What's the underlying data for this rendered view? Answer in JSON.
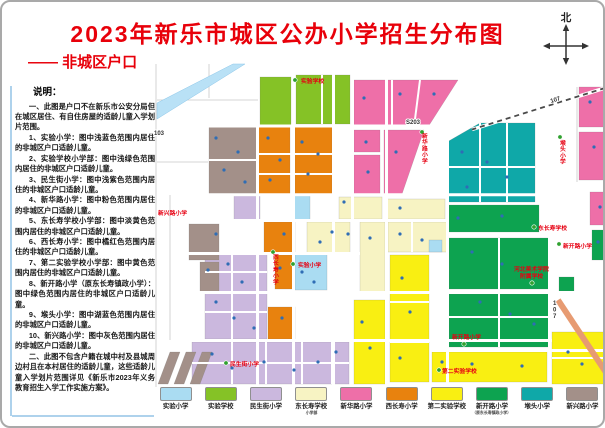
{
  "header": {
    "title": "2023年新乐市城区公办小学招生分布图",
    "subtitle": "—— 非城区户口",
    "compass_label": "北"
  },
  "notes": {
    "heading": "说明：",
    "paragraphs": [
      "一、此图是户口不在新乐市公安分局但在城区居住、有自住房屋的适龄儿童入学划片范围。",
      "1、实验小学：图中浅蓝色范围内居住的非城区户口适龄儿童。",
      "2、实验学校小学部：图中浅绿色范围内居住的非城区户口适龄儿童。",
      "3、民生街小学：图中浅紫色范围内居住的非城区户口适龄儿童。",
      "4、新华路小学：图中粉色范围内居住的非城区户口适龄儿童。",
      "5、东长寿学校小学部：图中淡黄色范围内居住的非城区户口适龄儿童。",
      "6、西长寿小学：图中橘红色范围内居住的非城区户口适龄儿童。",
      "7、第二实验学校小学部：图中黄色范围内居住的非城区户口适龄儿童。",
      "8、新开路小学（原东长寿镇政小学）：图中绿色范围内居住的非城区户口适龄儿童。",
      "9、堠头小学：图中湖蓝色范围内居住的非城区户口适龄儿童。",
      "10、新兴路小学：图中灰色范围内居住的非城区户口适龄儿童。",
      "二、此图不包含户籍在城中村及县城周边村且在本村居住的适龄儿童，这些适龄儿童入学划片范围详见《新乐市2023年义务教育招生入学工作实施方案》。"
    ]
  },
  "legend": {
    "items": [
      {
        "key": "sy",
        "label": "实验小学",
        "color": "#aadcf2"
      },
      {
        "key": "syxx",
        "label": "实验学校",
        "color": "#85c226"
      },
      {
        "key": "msj",
        "label": "民生街小学",
        "color": "#cbb8de"
      },
      {
        "key": "dcs",
        "label": "东长寿学校",
        "label2": "小学部",
        "color": "#f7f3c3"
      },
      {
        "key": "xhl",
        "label": "新华路小学",
        "color": "#ee6fa8"
      },
      {
        "key": "xcs",
        "label": "西长寿小学",
        "color": "#e8820e"
      },
      {
        "key": "desy",
        "label": "第二实验学校",
        "color": "#f9ef12"
      },
      {
        "key": "xkl",
        "label": "新开路小学",
        "label2": "（原东长寿镇政小学）",
        "color": "#0da350"
      },
      {
        "key": "ht",
        "label": "堠头小学",
        "color": "#0fa8a8"
      },
      {
        "key": "xxl",
        "label": "新兴路小学",
        "color": "#a39089"
      }
    ]
  },
  "map": {
    "road_labels": [
      {
        "text": "107",
        "x": 549,
        "y": 101,
        "rotate": -17
      },
      {
        "text": "S203",
        "x": 404,
        "y": 122
      },
      {
        "text": "107",
        "x": 551,
        "y": 303,
        "vertical": true
      },
      {
        "text": "103",
        "x": 152,
        "y": 133
      }
    ],
    "school_labels": [
      {
        "text": "实验学校",
        "x": 299,
        "y": 81,
        "marker": [
          293,
          78
        ]
      },
      {
        "text": "新华路小学",
        "x": 420,
        "y": 136,
        "vertical": true,
        "marker": [
          420,
          130
        ]
      },
      {
        "text": "西长寿小学",
        "x": 271,
        "y": 257,
        "vertical": true,
        "marker": [
          271,
          250
        ]
      },
      {
        "text": "实验小学",
        "x": 296,
        "y": 265,
        "marker": [
          291,
          262
        ]
      },
      {
        "text": "民生街小学",
        "x": 228,
        "y": 364,
        "marker": [
          224,
          361
        ]
      },
      {
        "text": "新兴路小学",
        "x": 156,
        "y": 213
      },
      {
        "text": "堠头小学",
        "x": 558,
        "y": 143,
        "vertical": true,
        "marker": [
          558,
          135
        ]
      },
      {
        "text": "东长寿学校",
        "x": 536,
        "y": 228,
        "marker": [
          532,
          225
        ]
      },
      {
        "text": "新开路小学",
        "x": 561,
        "y": 246,
        "marker": [
          557,
          242
        ]
      },
      {
        "text": "河北美术学院",
        "x": 512,
        "y": 269
      },
      {
        "text": "附属学校",
        "x": 518,
        "y": 276,
        "marker": [
          530,
          281
        ]
      },
      {
        "text": "新开路小学",
        "x": 450,
        "y": 337,
        "marker": [
          462,
          342
        ]
      },
      {
        "text": "第二实验学校",
        "x": 440,
        "y": 371,
        "marker": [
          437,
          368
        ]
      }
    ],
    "poi_dots": [
      [
        214,
        136
      ],
      [
        236,
        150
      ],
      [
        222,
        168
      ],
      [
        243,
        180
      ],
      [
        266,
        136
      ],
      [
        278,
        158
      ],
      [
        300,
        140
      ],
      [
        316,
        152
      ],
      [
        268,
        178
      ],
      [
        306,
        172
      ],
      [
        362,
        96
      ],
      [
        398,
        92
      ],
      [
        432,
        92
      ],
      [
        364,
        140
      ],
      [
        366,
        170
      ],
      [
        394,
        150
      ],
      [
        588,
        100
      ],
      [
        592,
        145
      ],
      [
        460,
        150
      ],
      [
        485,
        160
      ],
      [
        505,
        175
      ],
      [
        465,
        185
      ],
      [
        330,
        230
      ],
      [
        318,
        240
      ],
      [
        346,
        232
      ],
      [
        368,
        236
      ],
      [
        398,
        232
      ],
      [
        420,
        238
      ],
      [
        342,
        200
      ],
      [
        398,
        206
      ],
      [
        214,
        232
      ],
      [
        206,
        268
      ],
      [
        226,
        262
      ],
      [
        240,
        280
      ],
      [
        214,
        300
      ],
      [
        232,
        316
      ],
      [
        252,
        326
      ],
      [
        210,
        352
      ],
      [
        230,
        366
      ],
      [
        262,
        360
      ],
      [
        292,
        368
      ],
      [
        316,
        360
      ],
      [
        334,
        350
      ],
      [
        300,
        270
      ],
      [
        312,
        280
      ],
      [
        282,
        232
      ],
      [
        278,
        266
      ],
      [
        280,
        316
      ],
      [
        360,
        320
      ],
      [
        368,
        346
      ],
      [
        400,
        276
      ],
      [
        408,
        310
      ],
      [
        398,
        356
      ],
      [
        440,
        360
      ],
      [
        470,
        362
      ],
      [
        520,
        364
      ],
      [
        566,
        350
      ],
      [
        580,
        362
      ],
      [
        470,
        250
      ],
      [
        500,
        262
      ],
      [
        478,
        300
      ],
      [
        508,
        312
      ],
      [
        532,
        322
      ],
      [
        456,
        216
      ],
      [
        500,
        214
      ],
      [
        598,
        205
      ],
      [
        596,
        240
      ]
    ]
  }
}
